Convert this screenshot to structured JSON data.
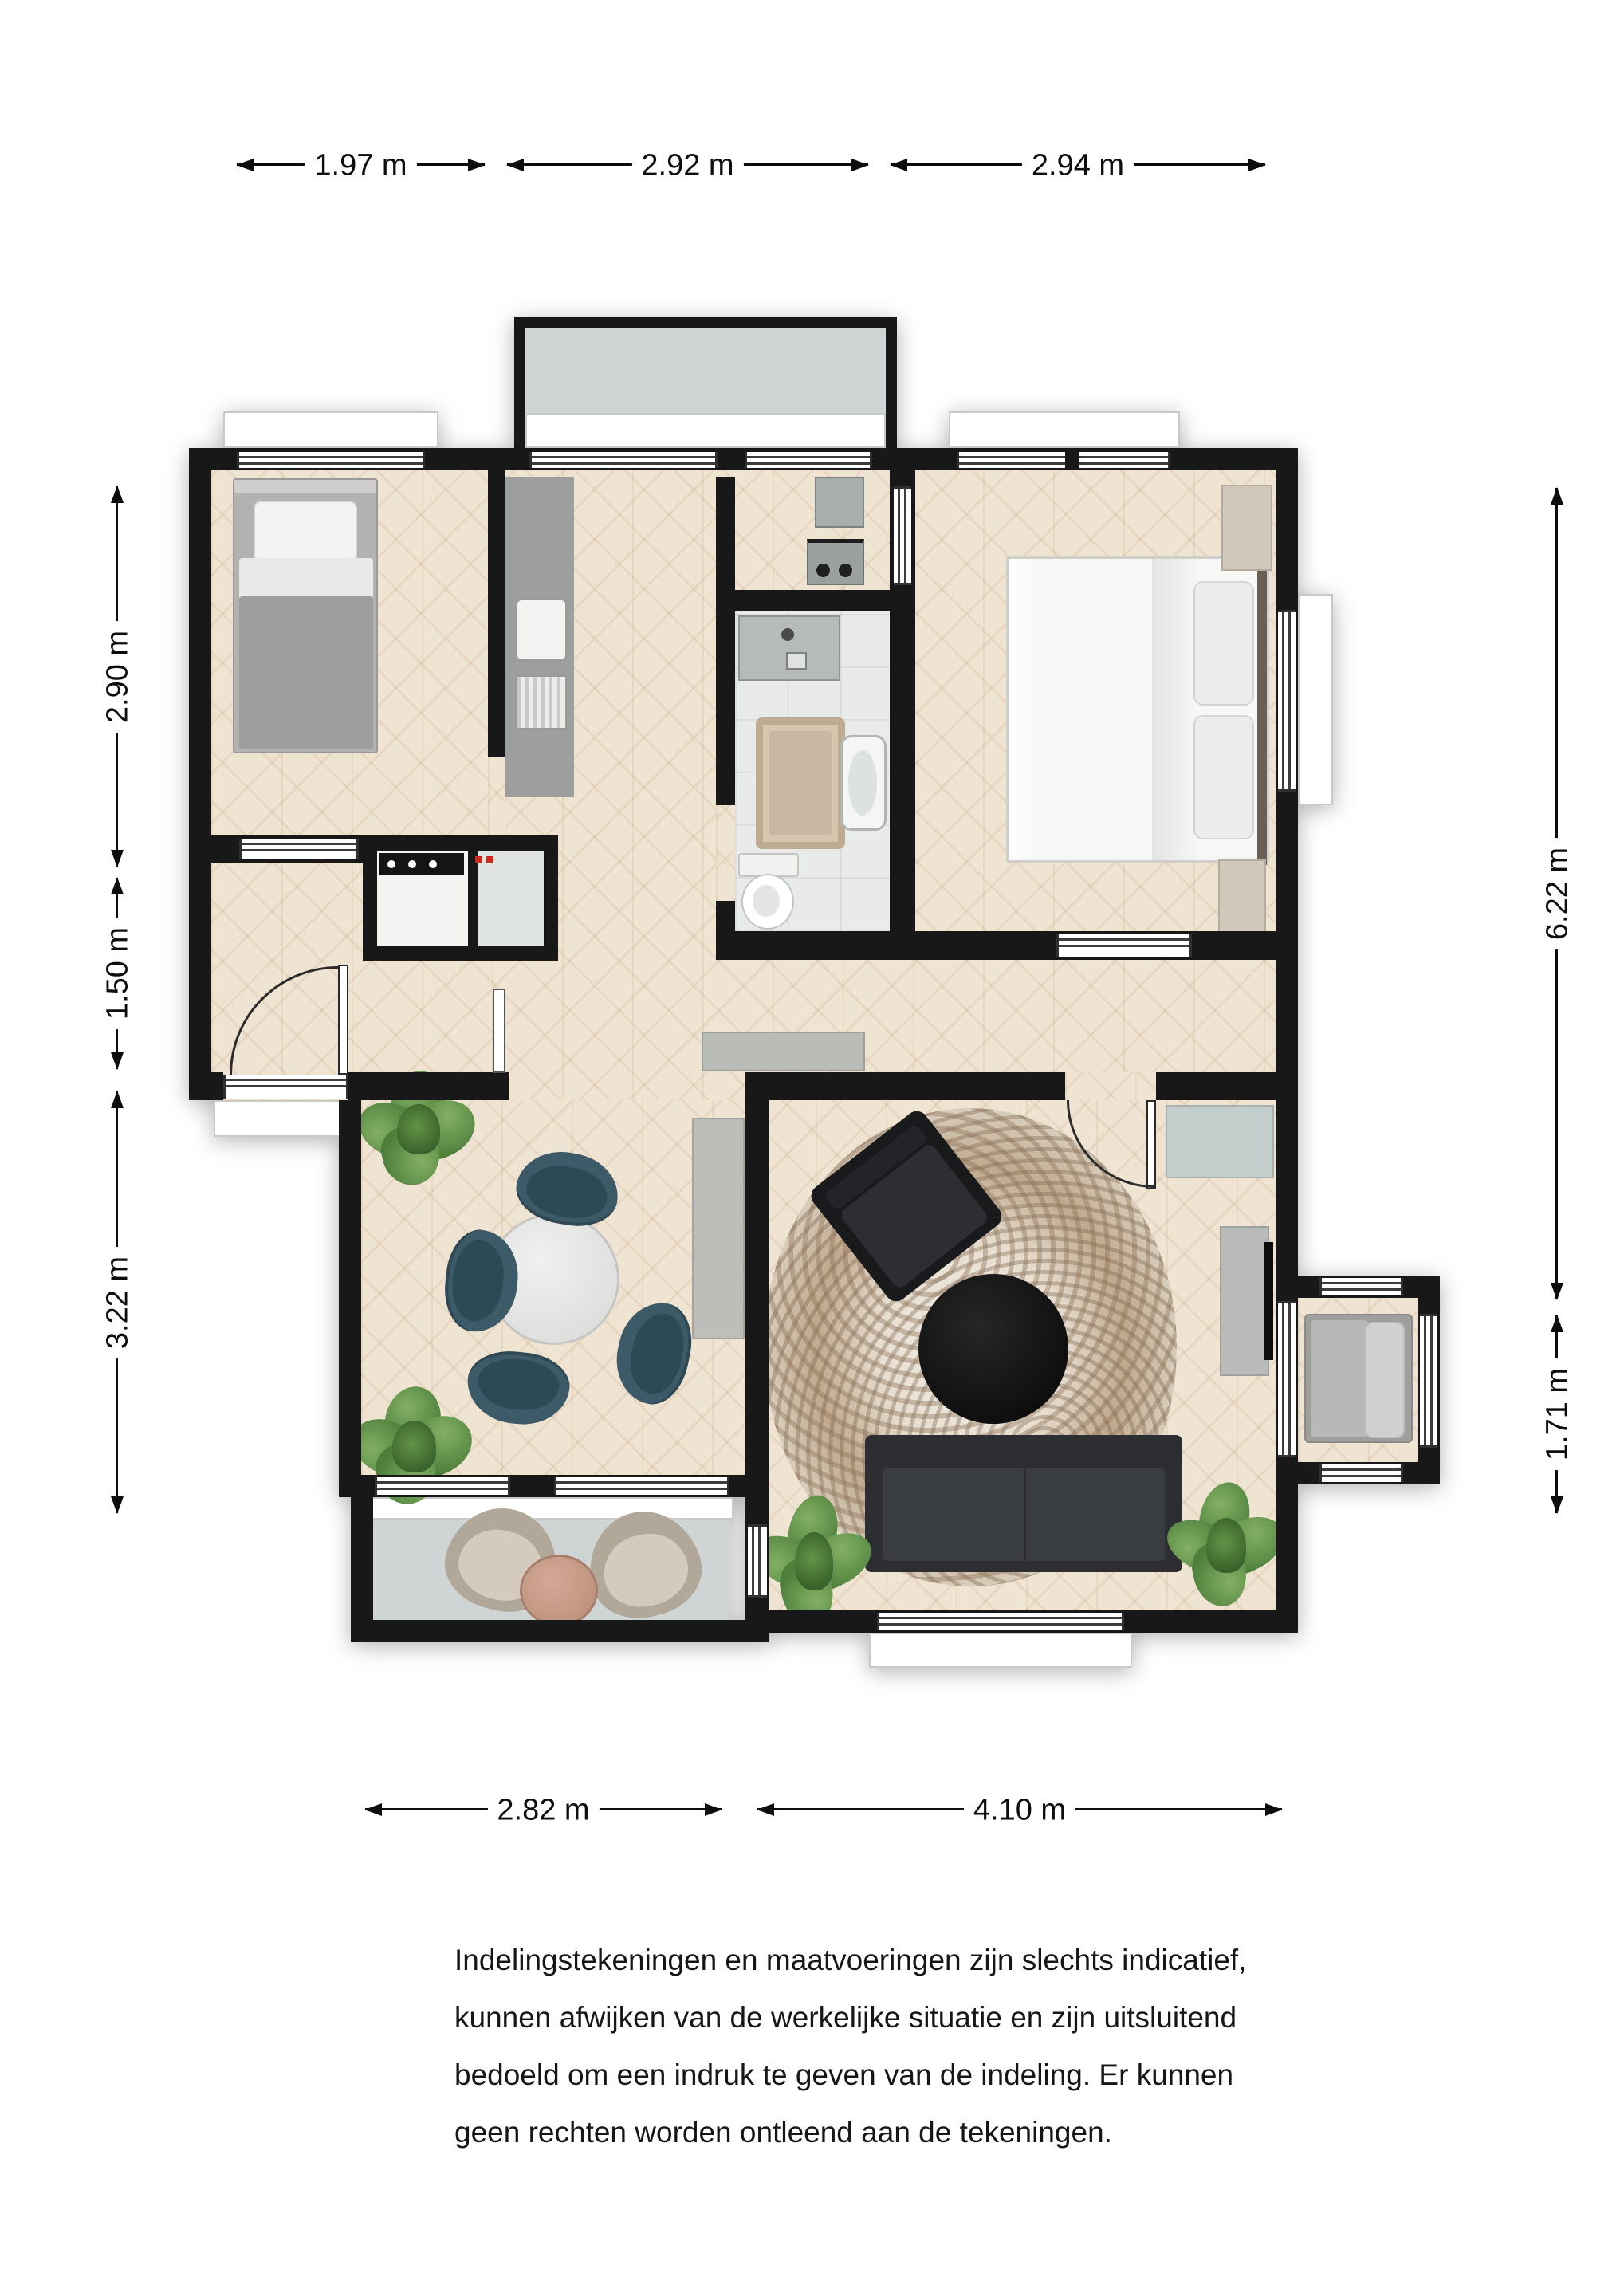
{
  "dimensions": {
    "top": [
      {
        "label": "1.97 m"
      },
      {
        "label": "2.92 m"
      },
      {
        "label": "2.94 m"
      }
    ],
    "left": [
      {
        "label": "2.90 m"
      },
      {
        "label": "1.50 m"
      },
      {
        "label": "3.22 m"
      }
    ],
    "right": [
      {
        "label": "6.22 m"
      },
      {
        "label": "1.71 m"
      }
    ],
    "bottom": [
      {
        "label": "2.82 m"
      },
      {
        "label": "4.10 m"
      }
    ]
  },
  "disclaimer": {
    "lines": [
      "Indelingstekeningen en maatvoeringen zijn slechts indicatief,",
      "kunnen afwijken van de werkelijke situatie en zijn uitsluitend",
      "bedoeld om een indruk te geven van de indeling. Er kunnen",
      "geen rechten worden ontleend aan de tekeningen."
    ]
  },
  "colors": {
    "wall": "#181818",
    "wood_floor": "#efe3d1",
    "balcony_floor": "#ced5d4",
    "bathroom_floor": "#e9ebea",
    "dining_chair": "#3d5a68",
    "plant_green": "#4d7e3a",
    "rug_speckle": "#93785c",
    "sofa": "#2c2e31"
  }
}
